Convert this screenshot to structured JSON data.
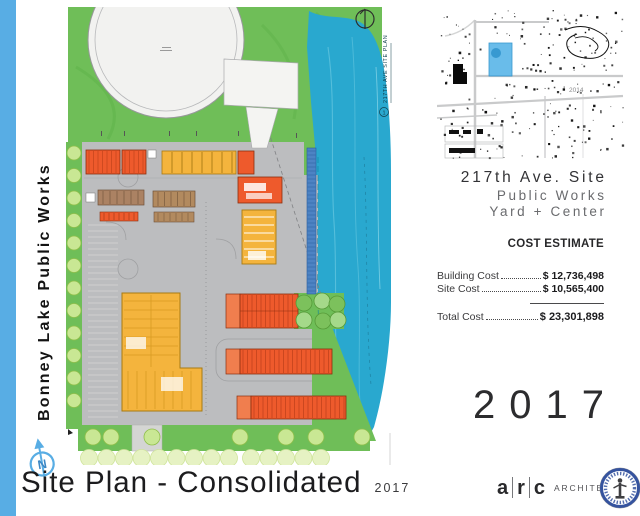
{
  "sidebar": {
    "label": "Bonney Lake Public Works"
  },
  "site_plan": {
    "drawing_title": "217TH AVE SITE PLAN",
    "drawing_number": "1",
    "north_label": "N"
  },
  "vicinity_map": {
    "year_label": "2014"
  },
  "project": {
    "title": "217th Ave. Site",
    "subtitle_line1": "Public Works",
    "subtitle_line2": "Yard + Center"
  },
  "cost_estimate": {
    "heading": "COST ESTIMATE",
    "rows": [
      {
        "label": "Building Cost",
        "value": "$ 12,736,498"
      },
      {
        "label": "Site Cost",
        "value": "$ 10,565,400"
      }
    ],
    "total": {
      "label": "Total Cost",
      "value": "$ 23,301,898"
    }
  },
  "year_large": "2017",
  "footer": {
    "title": "Site Plan - Consolidated",
    "year": "2017",
    "firm": {
      "l1": "a",
      "l2": "r",
      "l3": "c",
      "suffix": "ARCHITECTS"
    }
  },
  "colors": {
    "accent_blue": "#58ade4",
    "water": "#29a8cf",
    "landscape_green": "#6fbe58",
    "yard_gray": "#bcbdbf",
    "building_orange": "#ee5a2c",
    "building_yellow": "#f4b43d",
    "storage_brown": "#ab8263",
    "parcel_highlight": "#62b9e9"
  }
}
